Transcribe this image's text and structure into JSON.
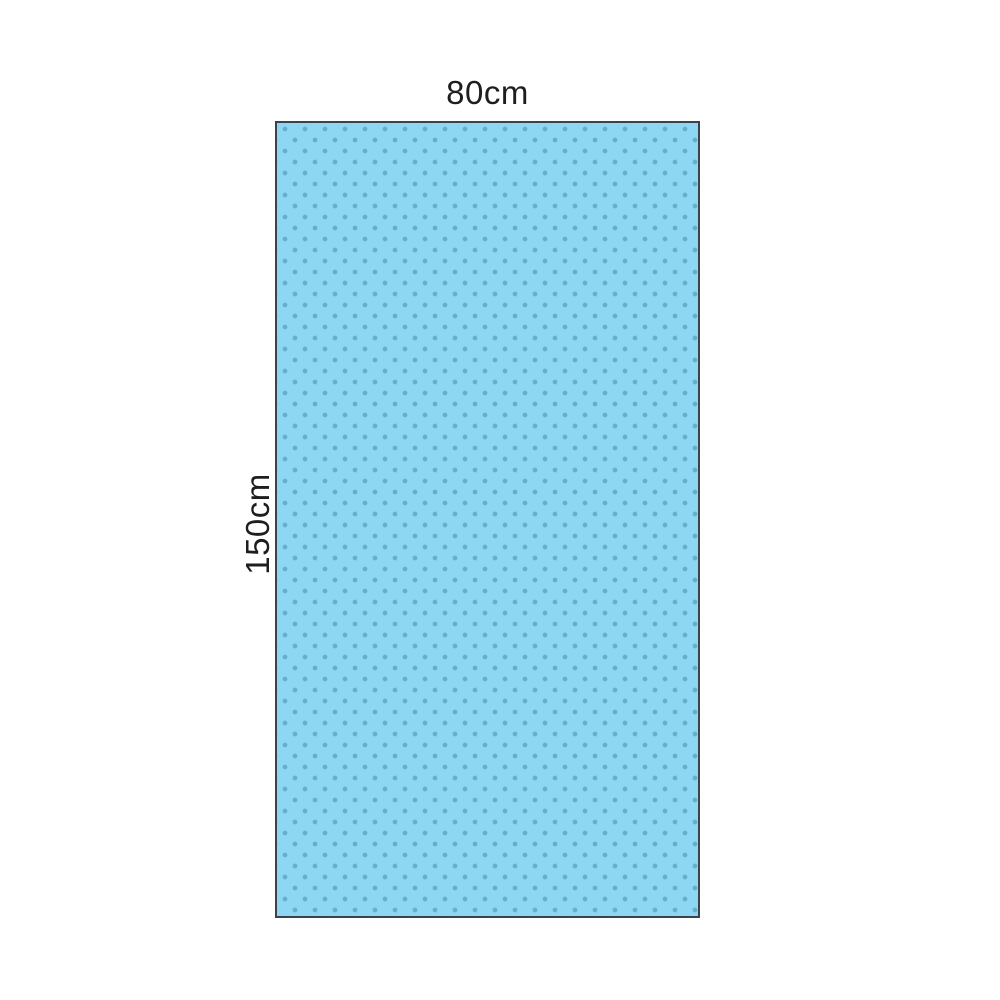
{
  "diagram": {
    "type": "product-dimension-diagram",
    "subject": "dotted drape sheet",
    "width_label": "80cm",
    "height_label": "150cm"
  },
  "colors": {
    "background": "#ffffff",
    "drape_fill": "#8dd7f2",
    "drape_dot": "#66aecd",
    "drape_border": "#3b4248",
    "label_text": "#1e1e1e"
  }
}
